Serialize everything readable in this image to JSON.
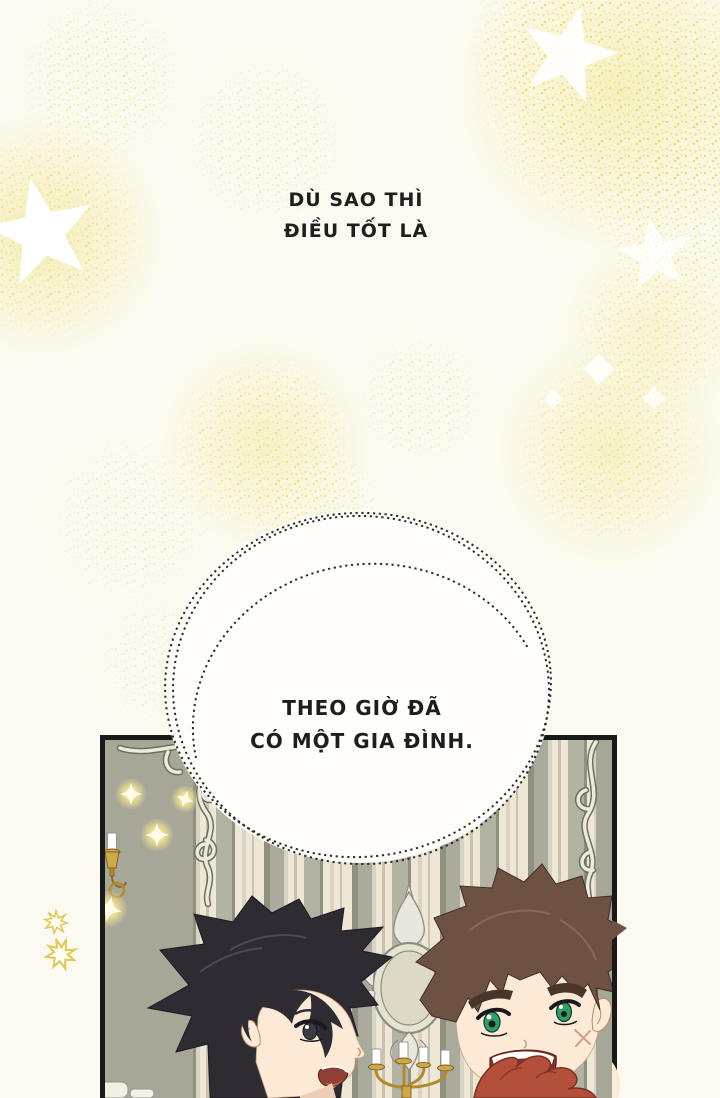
{
  "page": {
    "width": 720,
    "height": 1098,
    "background": "#fcfaf0",
    "kind": "comic page"
  },
  "narration_top": {
    "line1": "DÙ SAO THÌ",
    "line2": "ĐIỀU TỐT LÀ"
  },
  "speech_bubble": {
    "line1": "THEO GIỜ ĐÃ",
    "line2": "CÓ MỘT GIA ĐÌNH."
  },
  "panel": {
    "scene_elements": [
      "striped-wallpaper",
      "ornate-corner-frame-left",
      "ornate-frame-right",
      "wall-sconce",
      "central-mirror",
      "candelabra",
      "glow-sparkles",
      "black-haired-boy",
      "brown-haired-boy",
      "red-curly-hair-foreground"
    ]
  },
  "colors": {
    "background": "#fcfaf0",
    "speckle": "#e7dd6e",
    "bubble_fill": "#fffefb",
    "ink": "#1e1e1e",
    "wallpaper_cream": "#efe7d5",
    "wallpaper_gray": "#a7a798",
    "ornament_silver": "#eceadf",
    "gold": "#cfa84e",
    "hair_black": "#2e2b33",
    "hair_brown": "#6d5244",
    "skin": "#fce9d6",
    "eyes_green": "#2f9e68",
    "red_hair": "#b2503c"
  }
}
